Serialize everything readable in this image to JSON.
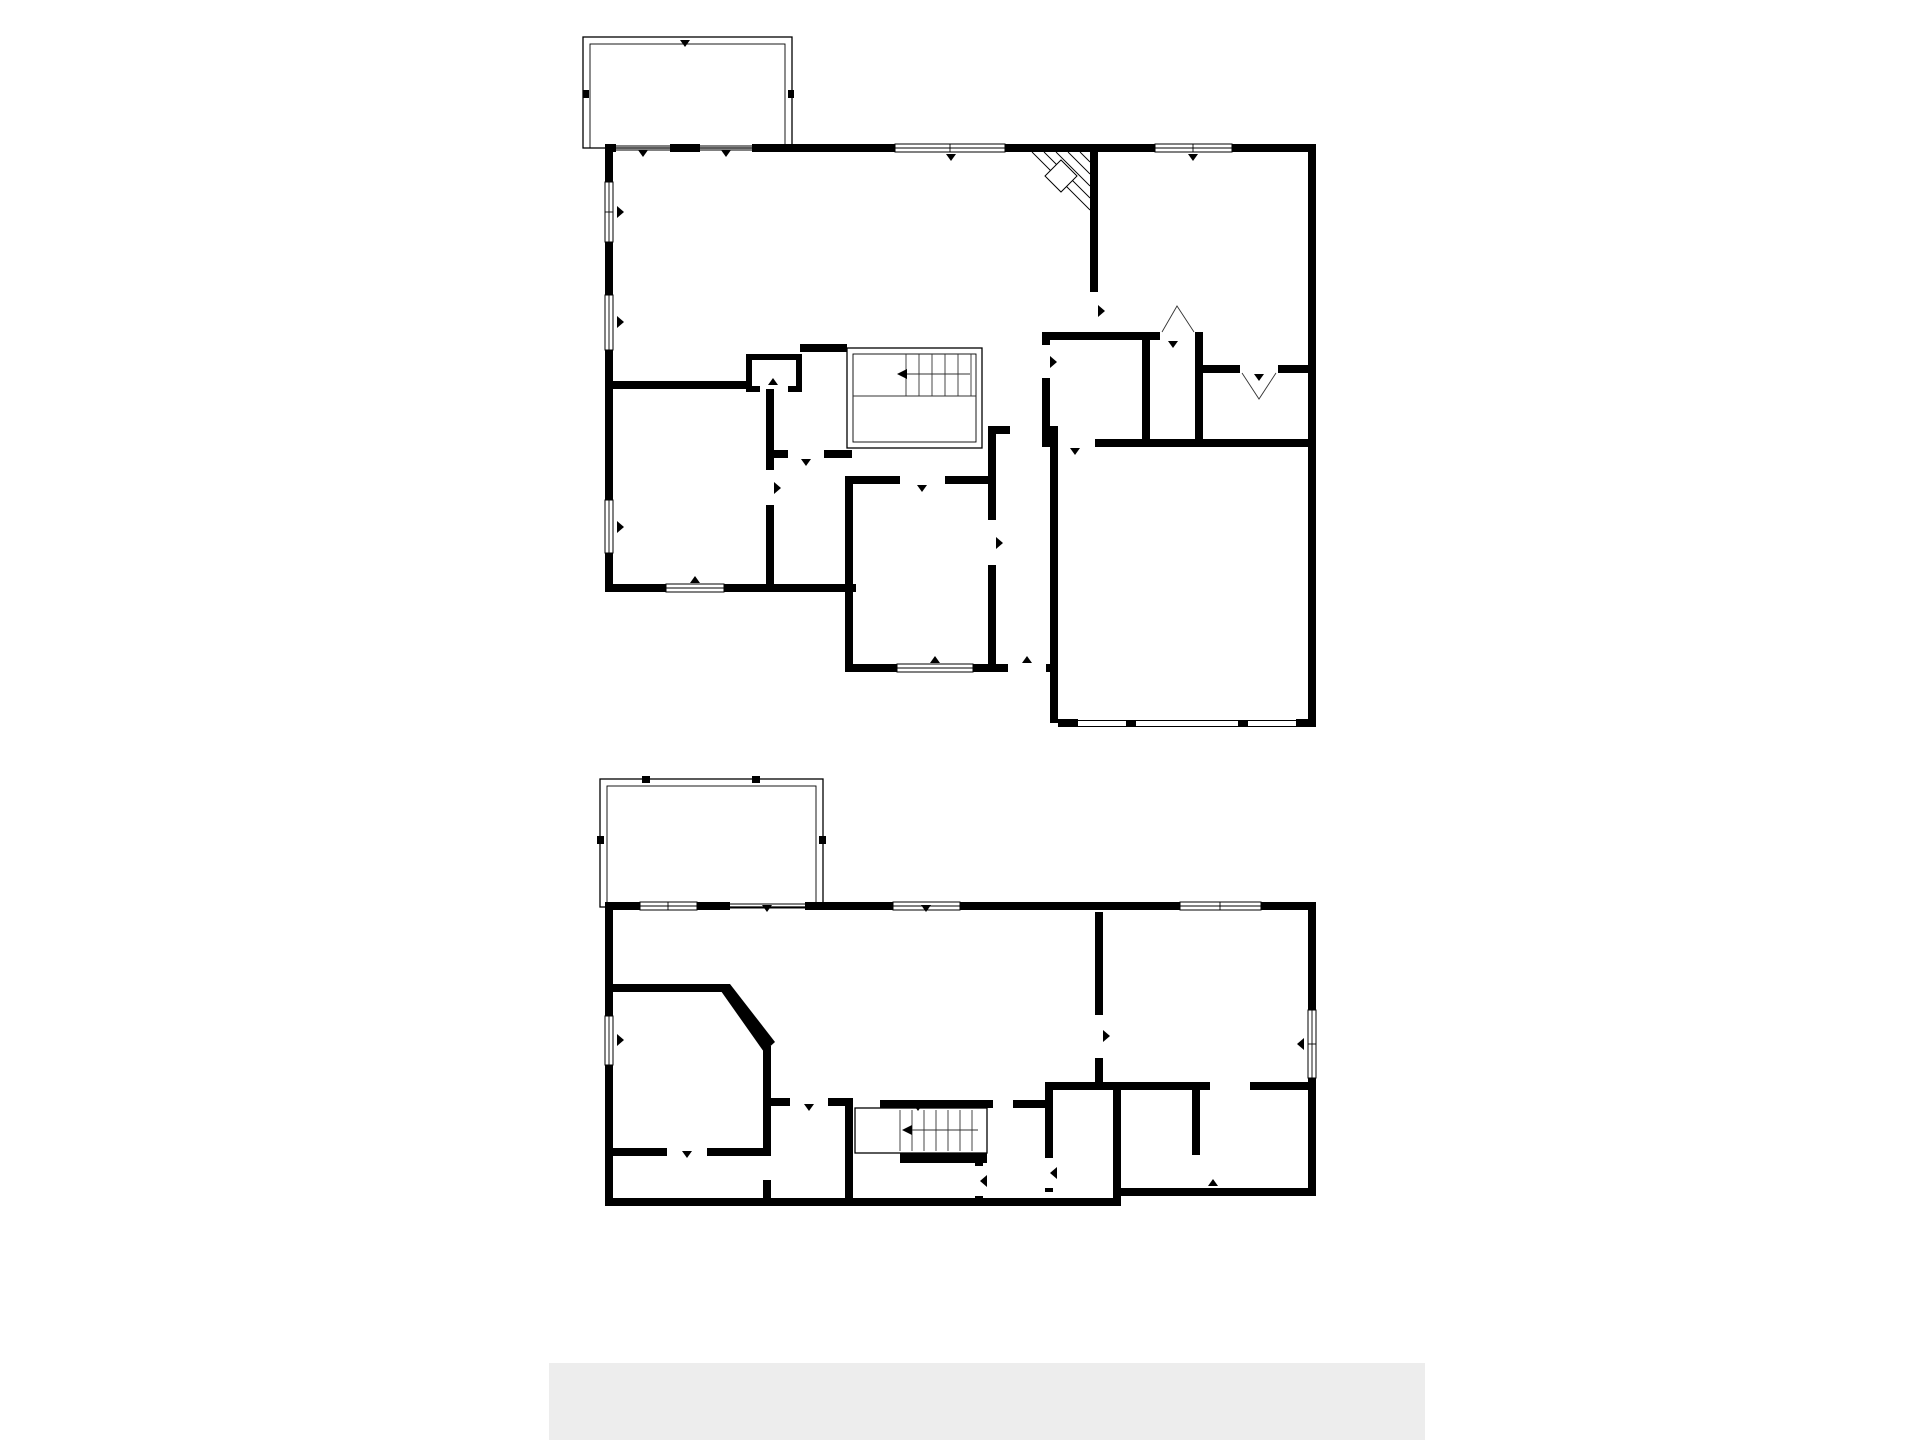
{
  "watermark": "© 2026",
  "colors": {
    "wall": "#000000",
    "text": "#3c3c3c",
    "watermark": "#8a8a8a",
    "bottom_bar": "#ededed"
  },
  "floors": [
    {
      "title": "1st floor",
      "rooms": [
        {
          "name": "BALCONY",
          "dims": "17'0\" x 7'8\""
        },
        {
          "name": "DINING AREA",
          "dims": "13'3\" x 7'10\""
        },
        {
          "name": "LIVING ROOM",
          "dims": "21'6\" x 14'1\""
        },
        {
          "name": "PRIMARY BEDROOM",
          "dims": "15'11\" x 14'2\""
        },
        {
          "name": "KITCHEN",
          "dims": "13'3\" x 8'9\""
        },
        {
          "name": "PANTRY",
          "dims": "2'6\" x 1'9\""
        },
        {
          "name": "HALL",
          "dims": "5'8\" x 8'1\""
        },
        {
          "name": "HALL",
          "dims": "5'3\" x 7'0\""
        },
        {
          "name": "LAUNDRY",
          "dims": "6'8\" x 6'9\""
        },
        {
          "name": "W.I.C.",
          "dims": "3'5\" x 7'9\""
        },
        {
          "name": "BATH",
          "dims": "8'5\" x 7'9\""
        },
        {
          "name": "BEDROOM",
          "dims": "12'11\" x 12'3\""
        },
        {
          "name": "BATH",
          "dims": "4'9\" x 8'11\""
        },
        {
          "name": "BEDROOM",
          "dims": "10'1\" x 13'0\""
        },
        {
          "name": "FOYER",
          "dims": "3'9\" x 15'8\""
        },
        {
          "name": "GARAGE",
          "dims": "19'0\" x 19'3\""
        }
      ]
    },
    {
      "title": "Basement 1",
      "rooms": [
        {
          "name": "COVERED PATIO",
          "dims": "16'0\" x 8'7\""
        },
        {
          "name": "OFFICE",
          "dims": "9'10\" x 5'7\""
        },
        {
          "name": "RECREATION ROOM",
          "dims": "25'4\" x 14'2\""
        },
        {
          "name": "BEDROOM",
          "dims": "15'6\" x 14'0\""
        },
        {
          "name": "BEDROOM",
          "dims": "13'0\" x 11'5\""
        },
        {
          "name": "BATH",
          "dims": "4'7\" x 8'10\""
        },
        {
          "name": "UTILITY",
          "dims": "5'7\" x 6'8\""
        },
        {
          "name": "HALL",
          "dims": "4'11\" x 6'8\""
        },
        {
          "name": "W.I.C.",
          "dims": "14'2\" x 5'11\""
        },
        {
          "name": "W.I.C.",
          "dims": "11'1\" x 3'6\""
        }
      ]
    }
  ]
}
